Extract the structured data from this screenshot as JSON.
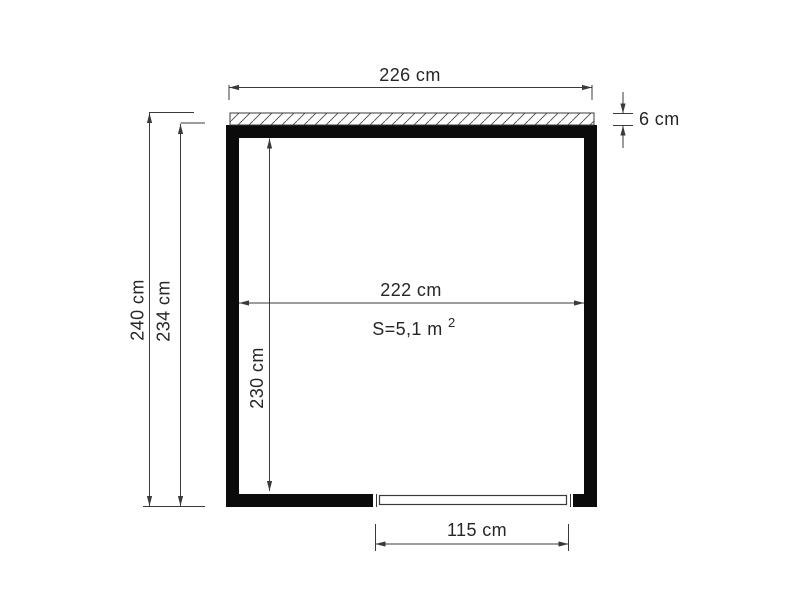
{
  "diagram": {
    "colors": {
      "background": "#ffffff",
      "wall": "#0b0b0b",
      "line": "#3a3a3a",
      "text": "#262626"
    },
    "labels": {
      "outer_width": "226 cm",
      "roof_thickness": "6 cm",
      "total_height": "240 cm",
      "wall_height": "234 cm",
      "inner_width": "222 cm",
      "inner_height": "230 cm",
      "door_width": "115 cm",
      "area_base": "S=5,1 m",
      "area_exponent": "2"
    }
  }
}
